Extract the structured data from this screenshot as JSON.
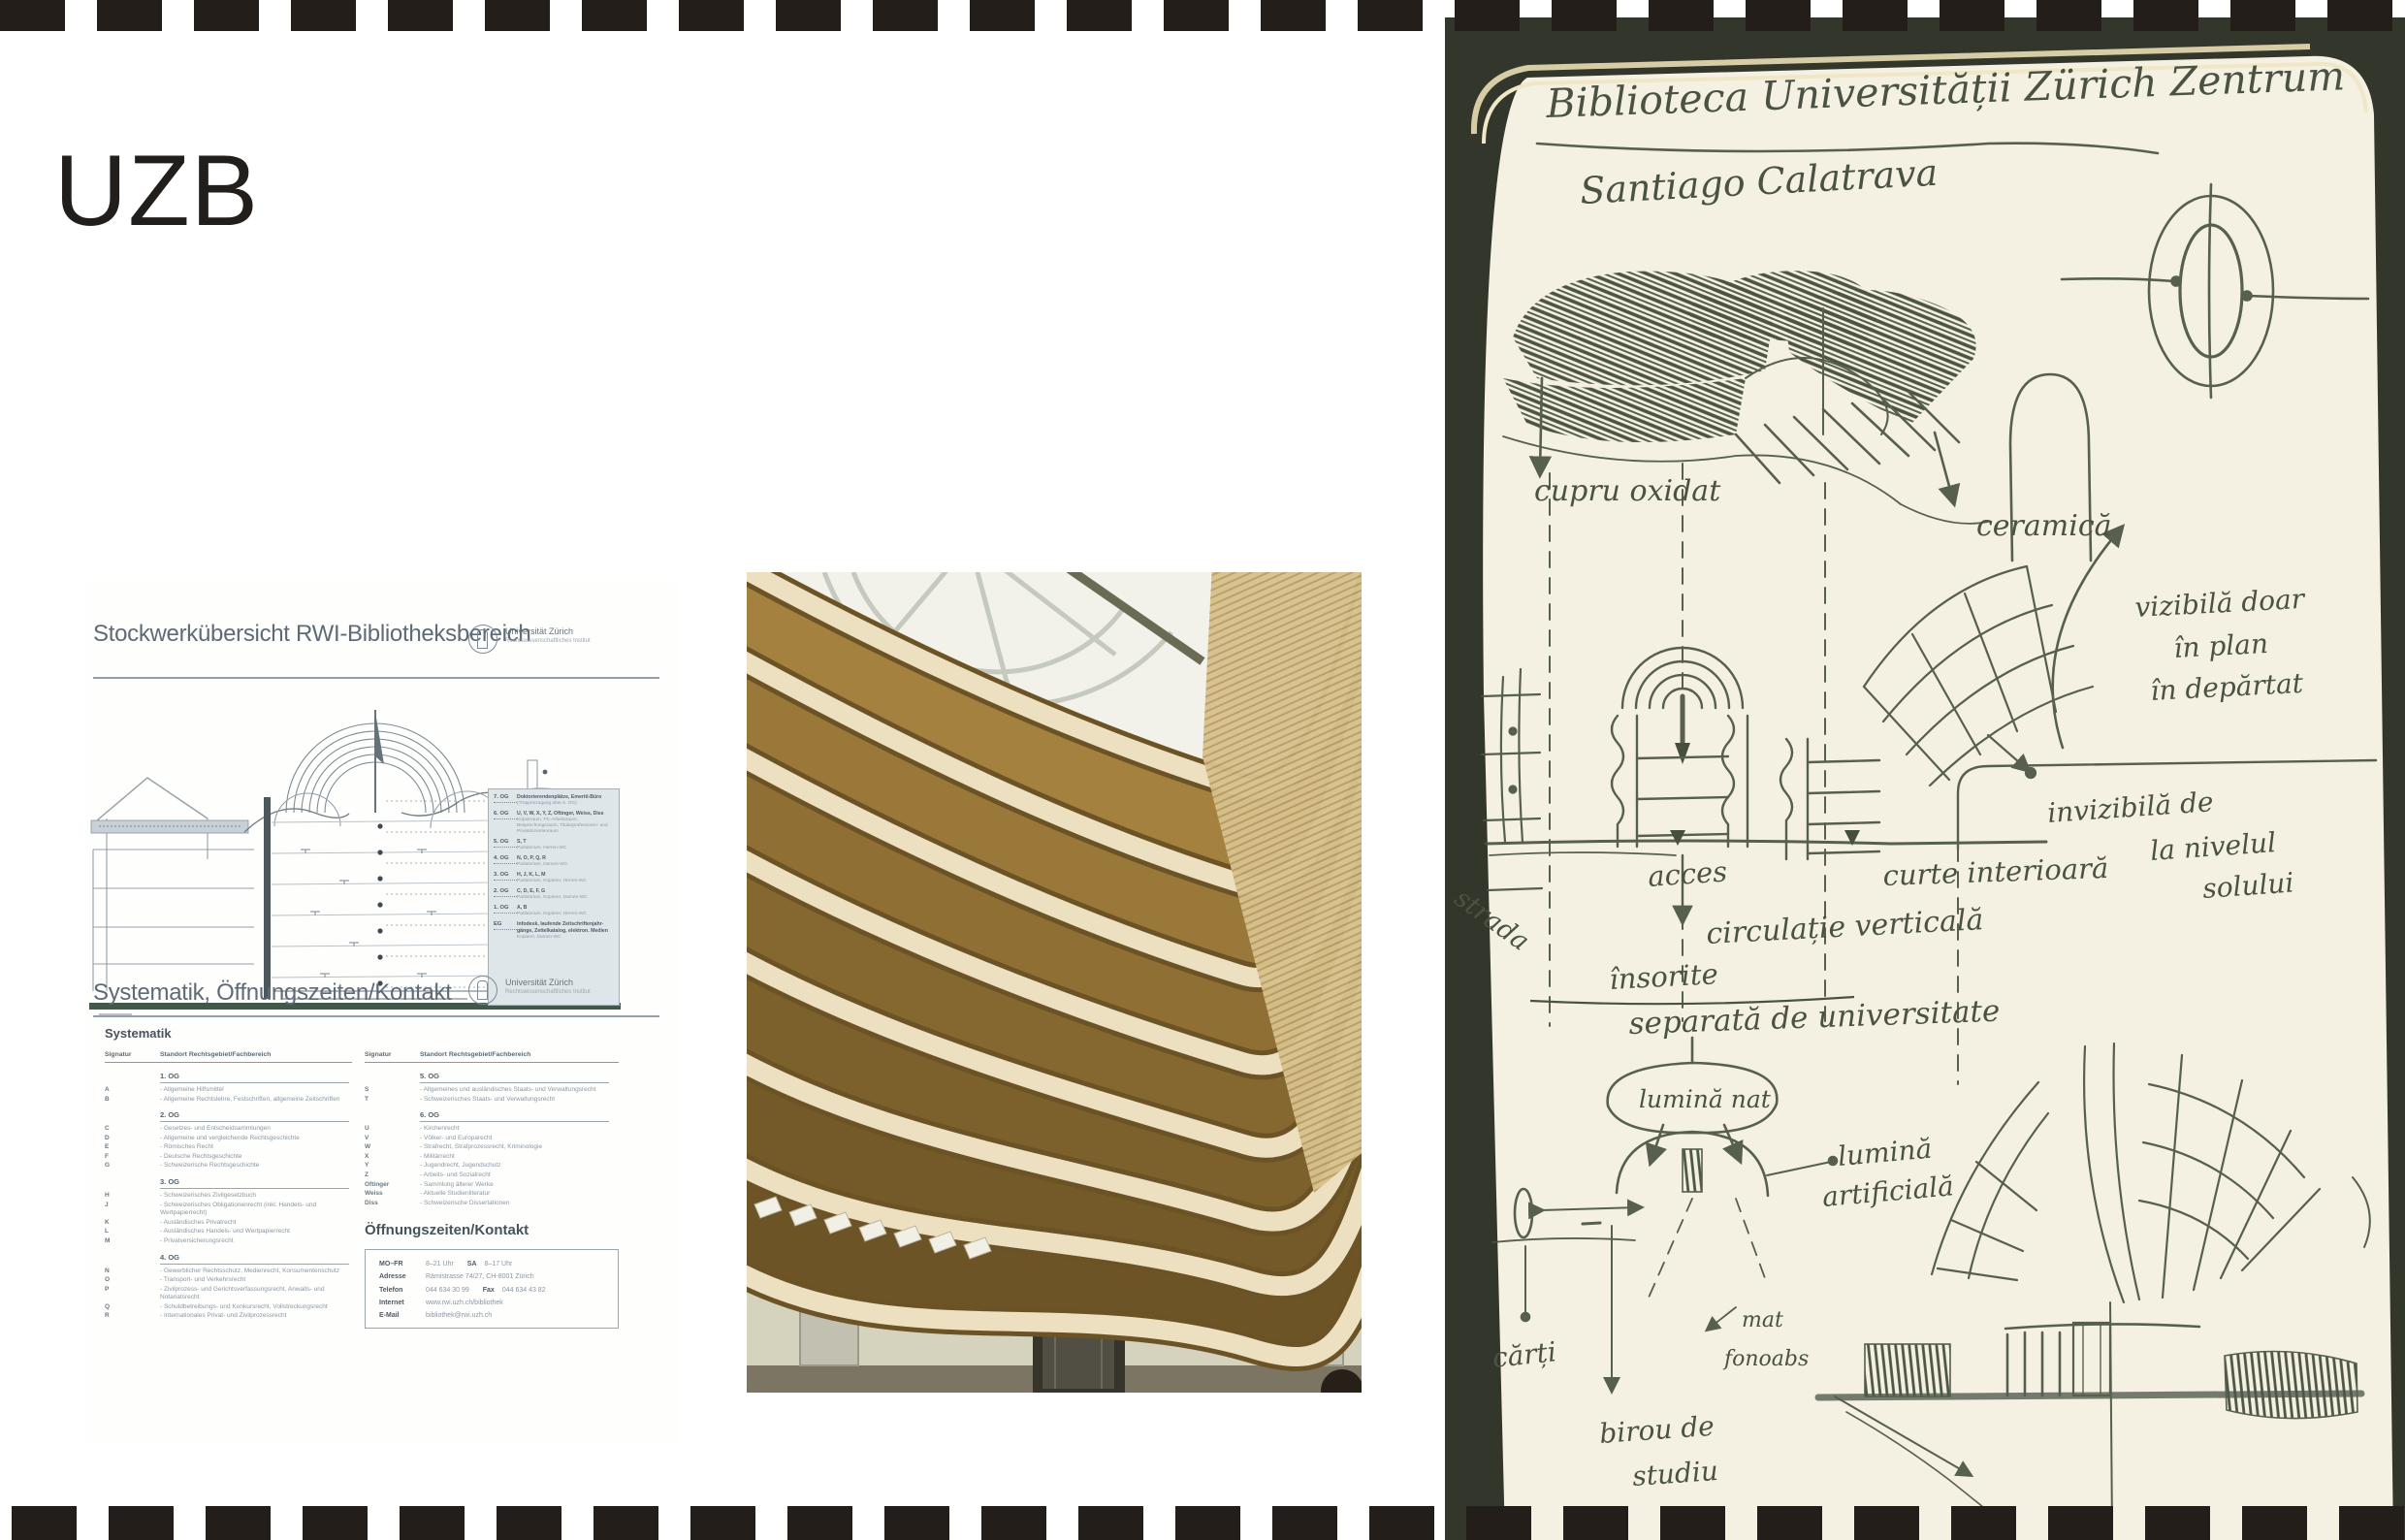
{
  "slide": {
    "title": "UZB"
  },
  "colors": {
    "film": "#231e1a",
    "ink": "#4a5343",
    "doc_accent": "#42584b",
    "wood": "#9a783c",
    "cream": "#ece0c1"
  },
  "document": {
    "page1_title": "Stockwerkübersicht RWI-Bibliotheksbereich",
    "page2_title": "Systematik, Öffnungszeiten/Kontakt",
    "logo_name": "Universität Zürich",
    "logo_sub": "Rechtswissenschaftliches Institut",
    "systematik_heading": "Systematik",
    "col_sig": "Signatur",
    "col_standort": "Standort Rechtsgebiet/Fachbereich",
    "hours_heading": "Öffnungszeiten/Kontakt",
    "legend": [
      {
        "floor": "7. OG",
        "bold": "Doktorierendenplätze, Emeriti-Büro",
        "sub": "(Treppenzugang über 6. OG)"
      },
      {
        "floor": "6. OG",
        "bold": "U, V, W, X, Y, Z, Oftinger, Weiss, Diss",
        "sub": "Kopierraum, PC-Arbeitsraum, Besprechungsraum, Titularprofessoren- und Privatdozentenraum"
      },
      {
        "floor": "5. OG",
        "bold": "S, T",
        "sub": "Parlatorium, Herren-WC"
      },
      {
        "floor": "4. OG",
        "bold": "N, O, P, Q, R",
        "sub": "Parlatorium, Damen-WC"
      },
      {
        "floor": "3. OG",
        "bold": "H, J, K, L, M",
        "sub": "Parlatorium, Kopierer, Herren-WC"
      },
      {
        "floor": "2. OG",
        "bold": "C, D, E, F, G",
        "sub": "Parlatorium, Kopierer, Damen-WC"
      },
      {
        "floor": "1. OG",
        "bold": "A, B",
        "sub": "Parlatorium, Kopierer, Herren-WC"
      },
      {
        "floor": "EG",
        "bold": "Infodesk, laufende Zeitschriftenjahr- gänge, Zettelkatalog, elektron. Medien",
        "sub": "Kopierer, Damen-WC"
      }
    ],
    "left_items": [
      {
        "head": "1. OG",
        "sig": "",
        "text": ""
      },
      {
        "head": "",
        "sig": "A",
        "text": "- Allgemeine Hilfsmittel"
      },
      {
        "head": "",
        "sig": "B",
        "text": "- Allgemeine Rechtslehre, Festschriften, allgemeine Zeitschriften"
      },
      {
        "head": "2. OG",
        "sig": "",
        "text": ""
      },
      {
        "head": "",
        "sig": "C",
        "text": "- Gesetzes- und Entscheidsammlungen"
      },
      {
        "head": "",
        "sig": "D",
        "text": "- Allgemeine und vergleichende Rechtsgeschichte"
      },
      {
        "head": "",
        "sig": "E",
        "text": "- Römisches Recht"
      },
      {
        "head": "",
        "sig": "F",
        "text": "- Deutsche Rechtsgeschichte"
      },
      {
        "head": "",
        "sig": "G",
        "text": "- Schweizerische Rechtsgeschichte"
      },
      {
        "head": "3. OG",
        "sig": "",
        "text": ""
      },
      {
        "head": "",
        "sig": "H",
        "text": "- Schweizerisches Zivilgesetzbuch"
      },
      {
        "head": "",
        "sig": "J",
        "text": "- Schweizerisches Obligationenrecht (inkl. Handels- und Wertpapierrecht)"
      },
      {
        "head": "",
        "sig": "K",
        "text": "- Ausländisches Privatrecht"
      },
      {
        "head": "",
        "sig": "L",
        "text": "- Ausländisches Handels- und Wertpapierrecht"
      },
      {
        "head": "",
        "sig": "M",
        "text": "- Privatversicherungsrecht"
      },
      {
        "head": "4. OG",
        "sig": "",
        "text": ""
      },
      {
        "head": "",
        "sig": "N",
        "text": "- Gewerblicher Rechtsschutz, Medienrecht, Konsumentenschutz"
      },
      {
        "head": "",
        "sig": "O",
        "text": "- Transport- und Verkehrsrecht"
      },
      {
        "head": "",
        "sig": "P",
        "text": "- Zivilprozess- und Gerichtsverfassungsrecht, Anwalts- und Notariatsrecht"
      },
      {
        "head": "",
        "sig": "Q",
        "text": "- Schuldbetreibungs- und Konkursrecht, Vollstreckungsrecht"
      },
      {
        "head": "",
        "sig": "R",
        "text": "- Internationales Privat- und Zivilprozessrecht"
      }
    ],
    "right_items": [
      {
        "head": "5. OG",
        "sig": "",
        "text": ""
      },
      {
        "head": "",
        "sig": "S",
        "text": "- Allgemeines und ausländisches Staats- und Verwaltungsrecht"
      },
      {
        "head": "",
        "sig": "T",
        "text": "- Schweizerisches Staats- und Verwaltungsrecht"
      },
      {
        "head": "6. OG",
        "sig": "",
        "text": ""
      },
      {
        "head": "",
        "sig": "U",
        "text": "- Kirchenrecht"
      },
      {
        "head": "",
        "sig": "V",
        "text": "- Völker- und Europarecht"
      },
      {
        "head": "",
        "sig": "W",
        "text": "- Strafrecht, Strafprozessrecht, Kriminologie"
      },
      {
        "head": "",
        "sig": "X",
        "text": "- Militärrecht"
      },
      {
        "head": "",
        "sig": "Y",
        "text": "- Jugendrecht, Jugendschutz"
      },
      {
        "head": "",
        "sig": "Z",
        "text": "- Arbeits- und Sozialrecht"
      },
      {
        "head": "",
        "sig": "Oftinger",
        "text": "- Sammlung älterer Werke"
      },
      {
        "head": "",
        "sig": "Weiss",
        "text": "- Aktuelle Studienliteratur"
      },
      {
        "head": "",
        "sig": "Diss",
        "text": "- Schweizerische Dissertationen"
      }
    ],
    "contact": [
      {
        "label": "MO–FR",
        "value": "8–21 Uhr",
        "label2": "SA",
        "value2": "8–17 Uhr"
      },
      {
        "label": "Adresse",
        "value": "Rämistrasse 74/27, CH-8001 Zürich",
        "label2": "",
        "value2": ""
      },
      {
        "label": "Telefon",
        "value": "044 634 30 99",
        "label2": "Fax",
        "value2": "044 634 43 82"
      },
      {
        "label": "Internet",
        "value": "www.rwi.uzh.ch/bibliothek",
        "label2": "",
        "value2": ""
      },
      {
        "label": "E-Mail",
        "value": "bibliothek@rwi.uzh.ch",
        "label2": "",
        "value2": ""
      }
    ]
  },
  "sketch": {
    "title": "Biblioteca Universității Zürich Zentrum",
    "architect": "Santiago Calatrava",
    "cupru": "cupru oxidat",
    "ceramica": "ceramică",
    "vizibila1": "vizibilă doar",
    "vizibila2": "în plan",
    "vizibila3": "în depărtat",
    "invizibila1": "invizibilă de",
    "invizibila2": "la nivelul",
    "invizibila3": "solului",
    "strada": "strada",
    "acces": "acces",
    "curte": "curte interioară",
    "circulatie": "circulație verticală",
    "insorite": "însorite",
    "separata": "separată de universitate",
    "lumina_nat": "lumină nat",
    "lumina_art1": "lumină",
    "lumina_art2": "artificială",
    "carti": "cărți",
    "mat1": "mat",
    "mat2": "fonoabs",
    "birou1": "birou de",
    "birou2": "studiu"
  }
}
